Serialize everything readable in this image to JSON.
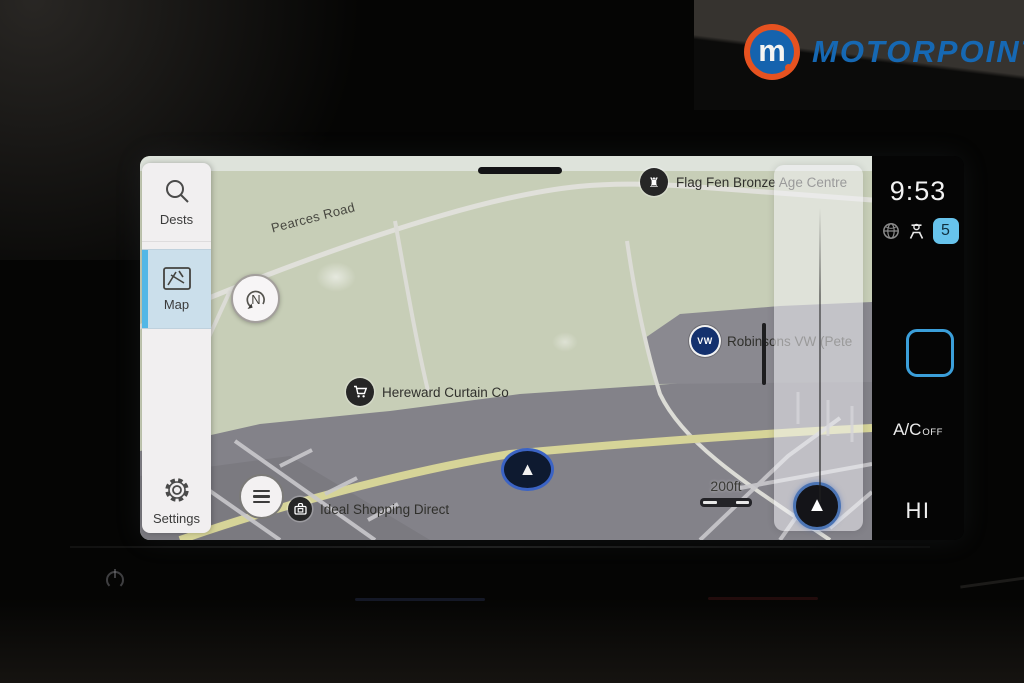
{
  "branding": {
    "name": "MOTORPOINT",
    "monogram": "m",
    "orange": "#e65220",
    "blue": "#1668b3"
  },
  "sidebar": {
    "items": [
      {
        "label": "Dests",
        "icon": "search-icon",
        "active": false
      },
      {
        "label": "Map",
        "icon": "map-icon",
        "active": true
      },
      {
        "label": "Settings",
        "icon": "gear-icon",
        "active": false
      }
    ],
    "active_accent": "#53b7e6"
  },
  "map": {
    "road_label": "Pearces Road",
    "compass_letter": "N",
    "scale_label": "200ft",
    "pois": [
      {
        "name": "Flag Fen Bronze Age Centre",
        "icon": "castle-icon"
      },
      {
        "name": "Robinsons VW (Pete",
        "icon": "vw-badge-icon"
      },
      {
        "name": "Hereward Curtain Co",
        "icon": "shopping-cart-icon"
      },
      {
        "name": "Ideal Shopping Direct",
        "icon": "briefcase-icon"
      }
    ],
    "colors": {
      "land_green": "#c7ceb7",
      "built_gray": "#838289",
      "road_yellow": "#e6e59d",
      "road_white": "#e0e0da"
    }
  },
  "status": {
    "clock": "9:53",
    "badge": "5",
    "icons": [
      "globe-icon",
      "driver-profile-icon"
    ]
  },
  "climate": {
    "ac_label": "A/C",
    "ac_state": "OFF",
    "fan_level": "HI"
  }
}
